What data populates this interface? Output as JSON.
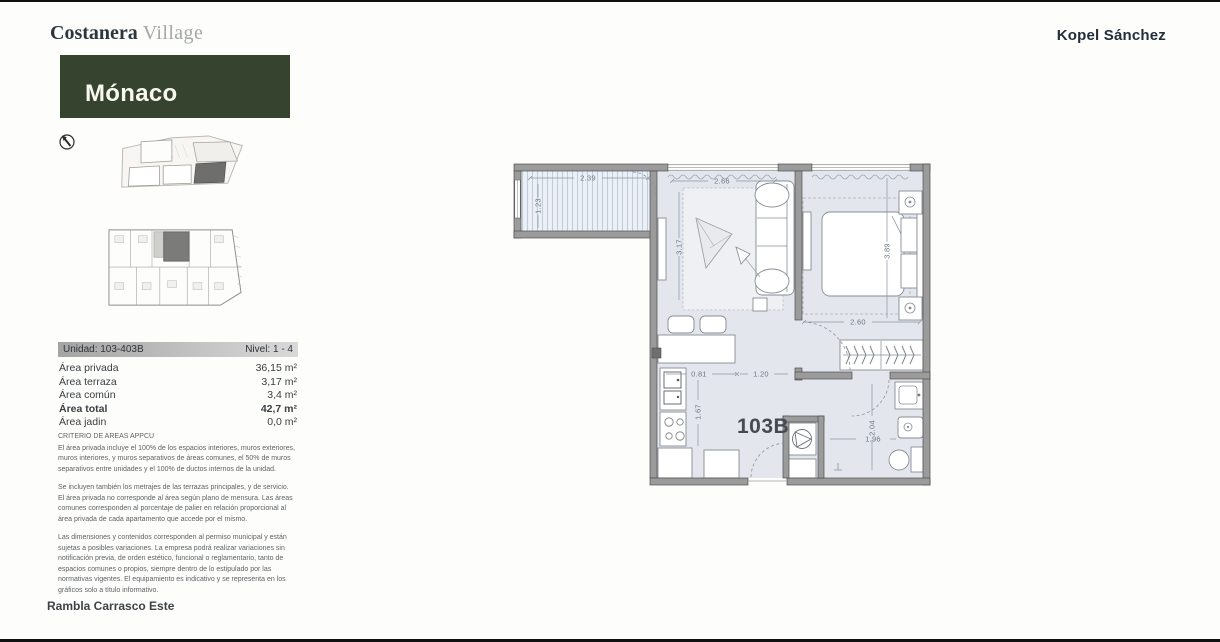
{
  "header": {
    "brand_primary": "Costanera",
    "brand_secondary": "Village",
    "project_name": "Mónaco",
    "developer": "Kopel Sánchez"
  },
  "colors": {
    "brand_green": "#36432f",
    "plan_wall_gray": "#9b9b9b",
    "plan_floor": "#e3e7ed"
  },
  "unit_info": {
    "unidad": "Unidad: 103-403B",
    "nivel": "Nivel: 1 - 4",
    "rows": [
      {
        "label": "Área privada",
        "value": "36,15 m²"
      },
      {
        "label": "Área terraza",
        "value": "3,17 m²"
      },
      {
        "label": "Área común",
        "value": "3,4 m²"
      },
      {
        "label": "Área total",
        "value": "42,7 m²"
      },
      {
        "label": "Área jadin",
        "value": "0,0 m²"
      }
    ]
  },
  "legal": {
    "heading": "CRITERIO DE AREAS APPCU",
    "p1": "El área privada incluye el 100% de los espacios interiores, muros exteriores, muros interiores, y muros separativos de áreas comunes, el 50% de muros separativos entre unidades y el 100% de ductos internos de la unidad.",
    "p2": "Se incluyen también los metrajes de las terrazas principales, y de servicio. El área privada no corresponde al área según plano de mensura. Las áreas comunes corresponden al porcentaje de palier en relación proporcional al área privada de cada apartamento que accede por el mismo.",
    "p3": "Las dimensiones y contenidos corresponden al permiso municipal y están sujetas a posibles variaciones. La empresa podrá realizar variaciones sin notificación previa, de orden estético, funcional o reglamentario, tanto de espacios comunes o propios, siempre dentro de lo estipulado por las normativas vigentes. El equipamiento es indicativo y se representa en los gráficos solo a título informativo."
  },
  "footer": {
    "location": "Rambla Carrasco Este"
  },
  "floor_plan": {
    "unit_label": "103B",
    "dims": {
      "terrace_width": "2.39",
      "terrace_depth": "1.23",
      "living_width": "2.66",
      "living_depth": "3.17",
      "bedroom_depth": "3.89",
      "bedroom_width": "2.60",
      "kitchen_a": "0.81",
      "kitchen_b": "1.20",
      "kitchen_depth": "1.67",
      "bath_depth": "2.04",
      "bath_width": "1.96"
    }
  }
}
